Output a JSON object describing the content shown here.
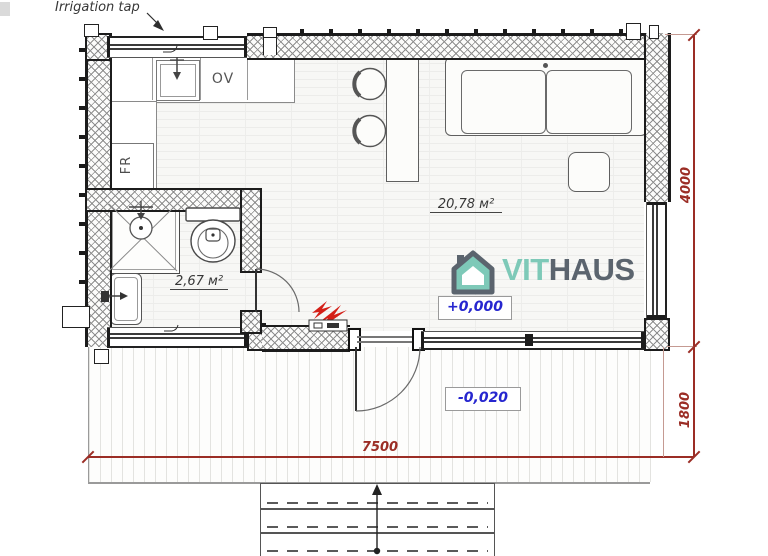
{
  "annotations": {
    "irrigation_tap": "Irrigation tap"
  },
  "rooms": {
    "main": {
      "area_label": "20,78 м²"
    },
    "bathroom": {
      "area_label": "2,67 м²"
    }
  },
  "appliances": {
    "oven": "OV",
    "fridge": "FR"
  },
  "levels": {
    "interior": "+0,000",
    "terrace": "-0,020"
  },
  "dimensions": {
    "house_depth": "4000",
    "terrace_depth": "1800",
    "overall_width": "7500"
  },
  "logo": {
    "brand_primary": "VIT",
    "brand_secondary": "HAUS"
  },
  "colors": {
    "dimension": "#9b2d25",
    "level_text": "#2626cf",
    "logo_teal": "#7ec9b8",
    "logo_slate": "#5b646e",
    "electric_red": "#d41f17",
    "wall_dark": "#1c1c1c"
  }
}
